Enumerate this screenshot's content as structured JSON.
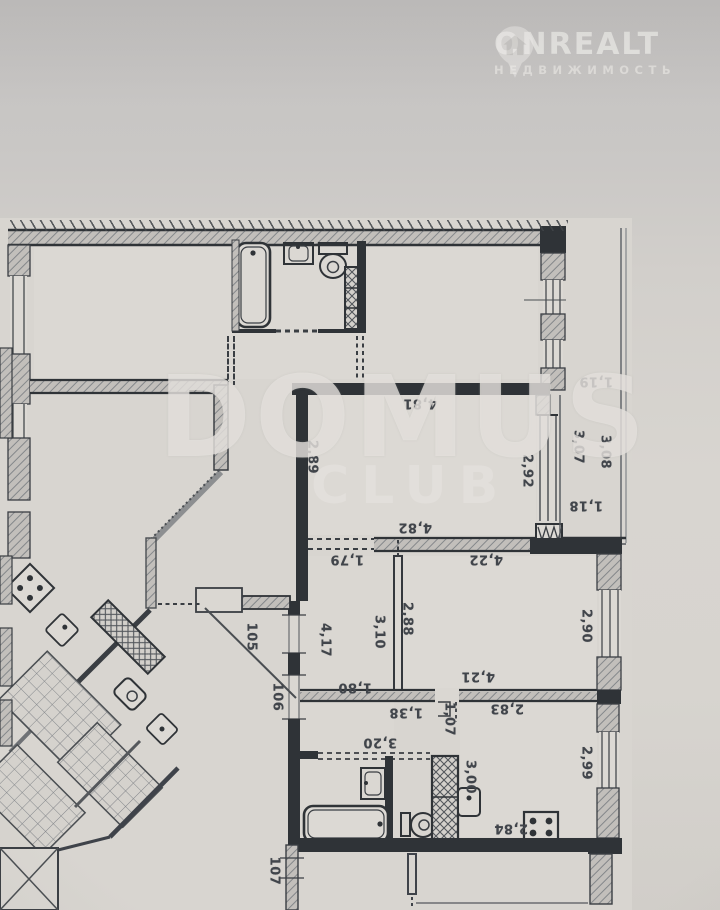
{
  "watermarks": {
    "domus": {
      "title": "DOMUS",
      "subtitle": "CLUB"
    },
    "onrealt": {
      "brand": "ONREALT",
      "subtitle": "НЕДВИЖИМОСТЬ",
      "icon": "house-pin-icon"
    }
  },
  "plan": {
    "type": "apartment-floor-plan",
    "units": "meters",
    "room_numbers": [
      "105",
      "106",
      "107"
    ],
    "dimension_labels": [
      {
        "text": "4,81",
        "x": 420,
        "y": 403,
        "rot": 180
      },
      {
        "text": "2,89",
        "x": 312,
        "y": 457,
        "rot": 90
      },
      {
        "text": "2,92",
        "x": 527,
        "y": 471,
        "rot": 90
      },
      {
        "text": "1,19",
        "x": 596,
        "y": 381,
        "rot": 180
      },
      {
        "text": "3,07",
        "x": 578,
        "y": 447,
        "rot": 90
      },
      {
        "text": "3,08",
        "x": 605,
        "y": 452,
        "rot": 90
      },
      {
        "text": "1,18",
        "x": 586,
        "y": 505,
        "rot": 180
      },
      {
        "text": "4,82",
        "x": 415,
        "y": 527,
        "rot": 180
      },
      {
        "text": "1,79",
        "x": 347,
        "y": 559,
        "rot": 180
      },
      {
        "text": "4,22",
        "x": 486,
        "y": 559,
        "rot": 180
      },
      {
        "text": "2,88",
        "x": 407,
        "y": 619,
        "rot": 90
      },
      {
        "text": "3,10",
        "x": 379,
        "y": 632,
        "rot": 90
      },
      {
        "text": "4,17",
        "x": 325,
        "y": 640,
        "rot": 90
      },
      {
        "text": "2,90",
        "x": 586,
        "y": 626,
        "rot": 90
      },
      {
        "text": "105",
        "x": 251,
        "y": 637,
        "rot": 90
      },
      {
        "text": "106",
        "x": 277,
        "y": 697,
        "rot": 90
      },
      {
        "text": "1,80",
        "x": 355,
        "y": 687,
        "rot": 180
      },
      {
        "text": "4,21",
        "x": 478,
        "y": 676,
        "rot": 180
      },
      {
        "text": "1,38",
        "x": 406,
        "y": 712,
        "rot": 180
      },
      {
        "text": "1,07",
        "x": 449,
        "y": 719,
        "rot": 90
      },
      {
        "text": "2,83",
        "x": 507,
        "y": 708,
        "rot": 180
      },
      {
        "text": "3,20",
        "x": 380,
        "y": 742,
        "rot": 180
      },
      {
        "text": "3,00",
        "x": 470,
        "y": 777,
        "rot": 90
      },
      {
        "text": "2,99",
        "x": 586,
        "y": 763,
        "rot": 90
      },
      {
        "text": "2,84",
        "x": 511,
        "y": 828,
        "rot": 180
      },
      {
        "text": "107",
        "x": 274,
        "y": 871,
        "rot": 90
      }
    ]
  },
  "colors": {
    "paper": "#d8d5d0",
    "wall_dark": "#2f3337",
    "wall_hatch": "#c3c0bc",
    "label": "#41454b"
  }
}
